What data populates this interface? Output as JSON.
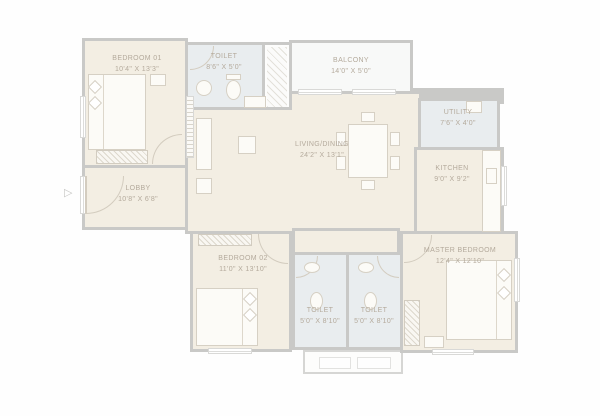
{
  "plan_title": "2BHK-style apartment floor plan",
  "palette": {
    "wall": "#c9c9c7",
    "room_floor": "#f3eee3",
    "wet_floor": "#e9edef",
    "balcony_floor": "#f8f9f8",
    "label_text": "#b4aa9c",
    "furniture_line": "#d6d0c4"
  },
  "icons": {
    "entry_arrow": "▷"
  },
  "rooms": [
    {
      "id": "bedroom-01",
      "name": "BEDROOM 01",
      "dims": "10'4\" X 13'3\""
    },
    {
      "id": "toilet-top",
      "name": "TOILET",
      "dims": "8'6\" X 5'0\""
    },
    {
      "id": "balcony",
      "name": "BALCONY",
      "dims": "14'0\" X 5'0\""
    },
    {
      "id": "utility",
      "name": "UTILITY",
      "dims": "7'6\" X 4'0\""
    },
    {
      "id": "kitchen",
      "name": "KITCHEN",
      "dims": "9'0\" X 9'2\""
    },
    {
      "id": "living-dining",
      "name": "LIVING/DINING",
      "dims": "24'2\" X 13'1\""
    },
    {
      "id": "lobby",
      "name": "LOBBY",
      "dims": "10'8\" X 6'8\""
    },
    {
      "id": "bedroom-02",
      "name": "BEDROOM 02",
      "dims": "11'0\" X 13'10\""
    },
    {
      "id": "toilet-left",
      "name": "TOILET",
      "dims": "5'0\" X 8'10\""
    },
    {
      "id": "toilet-right",
      "name": "TOILET",
      "dims": "5'0\" X 8'10\""
    },
    {
      "id": "master-bedroom",
      "name": "MASTER BEDROOM",
      "dims": "12'4\" X 12'10\""
    }
  ]
}
